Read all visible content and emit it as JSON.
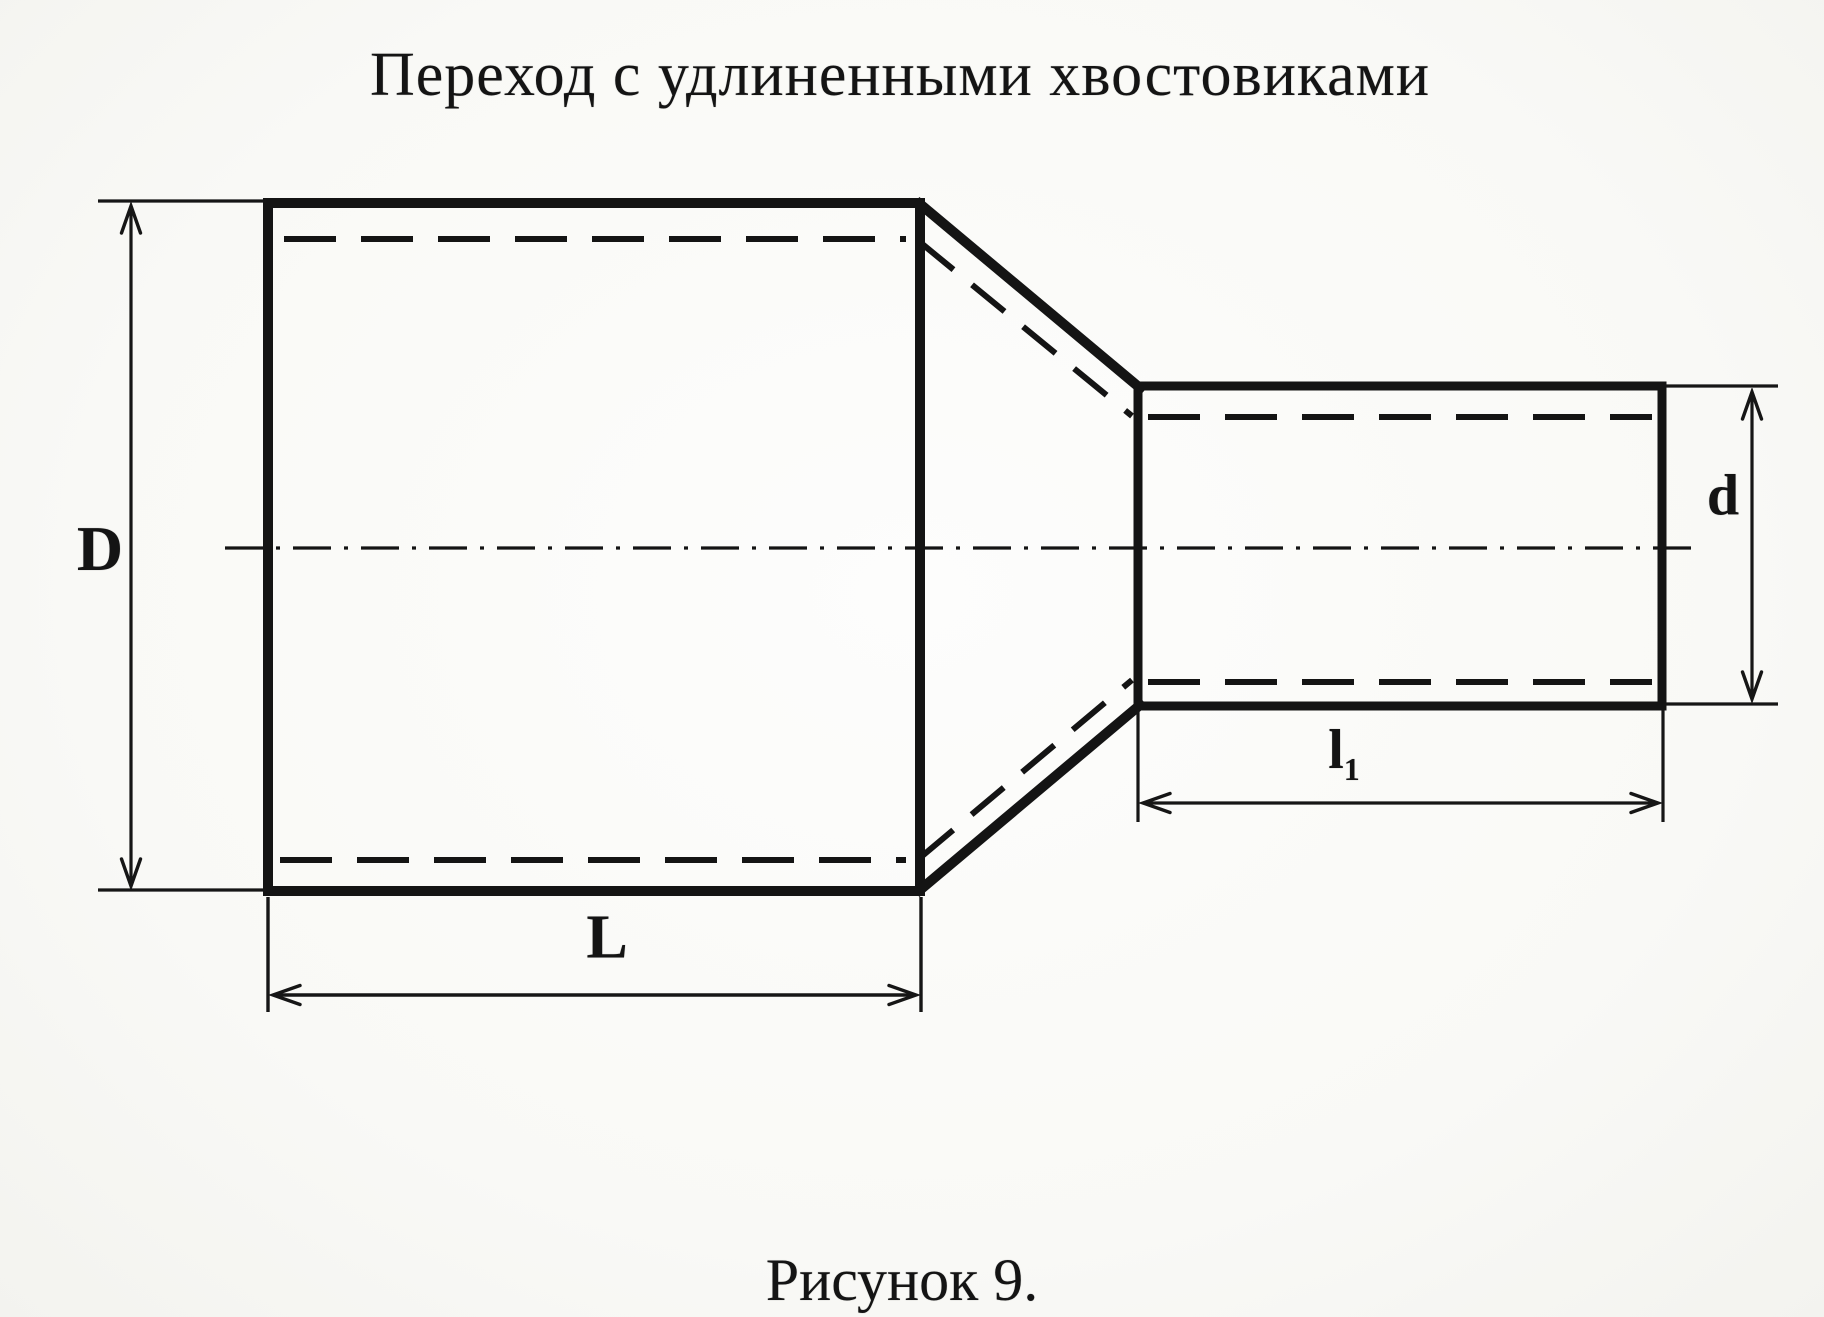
{
  "title": "Переход с удлиненными хвостовиками",
  "caption": "Рисунок 9.",
  "dimension_labels": {
    "outer_diameter": "D",
    "tail_diameter": "d",
    "body_length": "L",
    "tail_length_base": "l",
    "tail_length_sub": "1"
  },
  "colors": {
    "ink": "#161616",
    "paper": "#f9f9f6"
  }
}
